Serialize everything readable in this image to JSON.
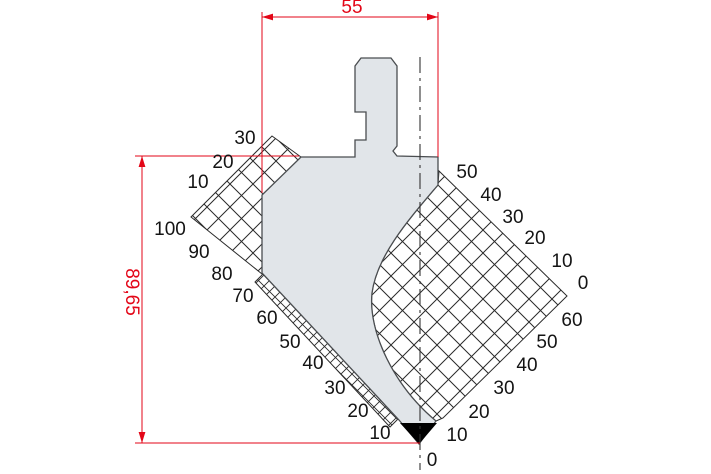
{
  "dimensions": {
    "width_label": "55",
    "height_label": "89,65"
  },
  "scales": {
    "left_upper": [
      "30",
      "20",
      "10"
    ],
    "left_main": [
      "100",
      "90",
      "80",
      "70",
      "60",
      "50",
      "40",
      "30",
      "20",
      "10"
    ],
    "origin": "0",
    "right_upper": [
      "50",
      "40",
      "30",
      "20",
      "10",
      "0"
    ],
    "right_lower": [
      "60",
      "50",
      "40",
      "30",
      "20",
      "10"
    ]
  },
  "colors": {
    "dimension_red": "#e30617",
    "body_fill": "#e1e5e9",
    "outline": "#4a4d50",
    "hatch": "#2a2a2a",
    "tip_fill": "#000000",
    "label_color": "#141414",
    "centerline": "#333333"
  }
}
